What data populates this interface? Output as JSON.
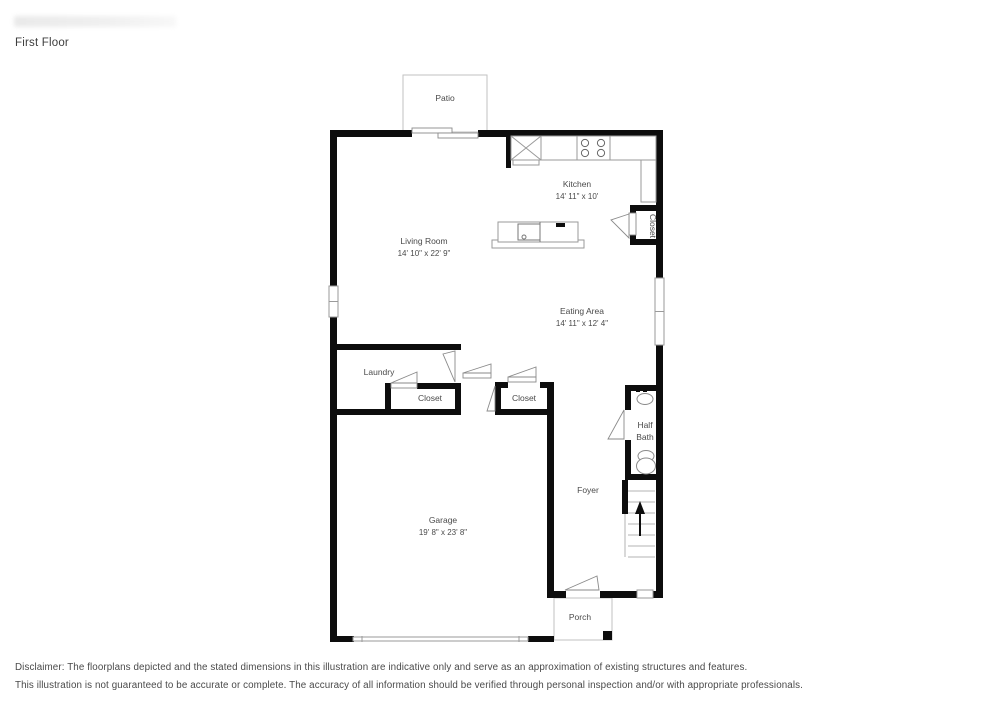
{
  "page": {
    "title": "First Floor",
    "disclaimer1": "Disclaimer: The floorplans depicted and the stated dimensions in this illustration are indicative only and serve as an approximation of existing structures and features.",
    "disclaimer2": "This illustration is not guaranteed to be accurate or complete. The accuracy of all information should be verified through personal inspection and/or with appropriate professionals."
  },
  "rooms": {
    "patio": {
      "label": "Patio"
    },
    "kitchen": {
      "label": "Kitchen",
      "dims": "14' 11\" x 10'"
    },
    "living": {
      "label": "Living Room",
      "dims": "14' 10\" x 22' 9\""
    },
    "eating": {
      "label": "Eating Area",
      "dims": "14' 11\" x 12' 4\""
    },
    "laundry": {
      "label": "Laundry"
    },
    "closet1": {
      "label": "Closet"
    },
    "closet2": {
      "label": "Closet"
    },
    "closet_kitchen": {
      "label": "Closet"
    },
    "halfbath": {
      "line1": "Half",
      "line2": "Bath"
    },
    "foyer": {
      "label": "Foyer"
    },
    "garage": {
      "label": "Garage",
      "dims": "19' 8\" x 23' 8\""
    },
    "porch": {
      "label": "Porch"
    }
  },
  "colors": {
    "wall": "#0d0d0d",
    "outline": "#9a9a9a",
    "label_text": "#4a4a4a"
  }
}
